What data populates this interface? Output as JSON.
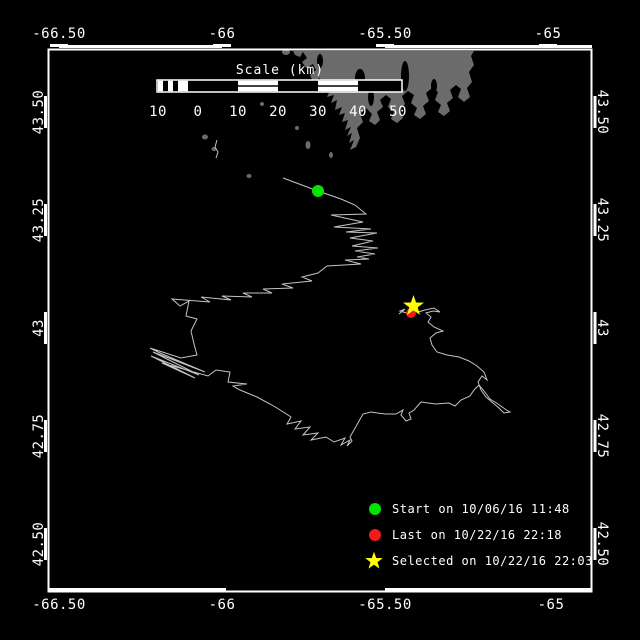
{
  "axes": {
    "lon": [
      "-66.50",
      "-66",
      "-65.50",
      "-65"
    ],
    "lat": [
      "43.50",
      "43.25",
      "43",
      "42.75",
      "42.50"
    ]
  },
  "scalebar": {
    "title": "Scale (km)",
    "labels": [
      "10",
      "0",
      "10",
      "20",
      "30",
      "40",
      "50"
    ]
  },
  "legend": {
    "items": [
      {
        "marker": "start-dot",
        "color": "#00e400",
        "label": "Start on 10/06/16 11:48"
      },
      {
        "marker": "last-dot",
        "color": "#f21b1b",
        "label": "Last on 10/22/16 22:18"
      },
      {
        "marker": "selected-star",
        "color": "#ffff00",
        "label": "Selected on 10/22/16 22:03"
      }
    ]
  },
  "markers": {
    "start": {
      "color": "#00e400"
    },
    "last": {
      "color": "#f21b1b"
    },
    "selected": {
      "color": "#ffff00"
    }
  },
  "colors": {
    "background": "#000000",
    "frame": "#ffffff",
    "land": "#6b6b6b",
    "track": "#c4c4c4",
    "text": "#ffffff"
  }
}
